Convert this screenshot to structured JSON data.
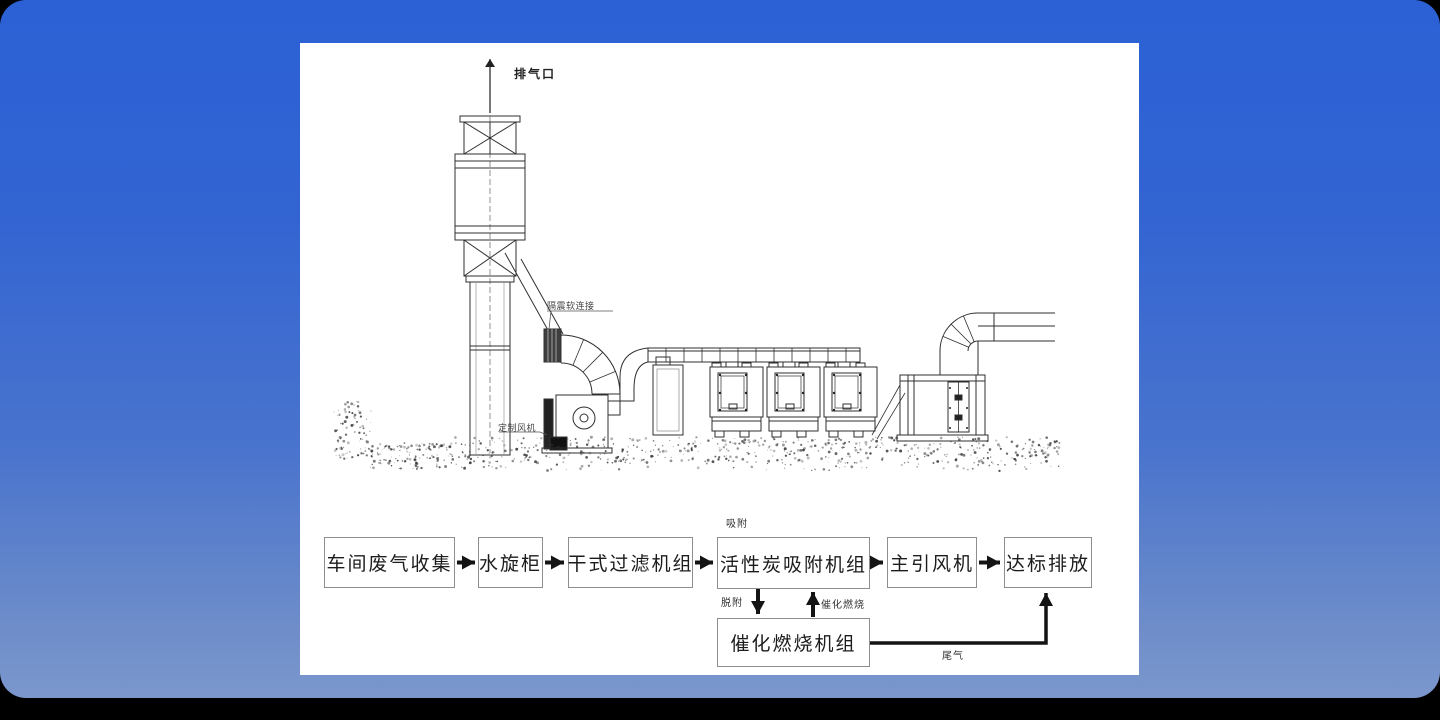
{
  "colors": {
    "page_background": "#000000",
    "slide_background_top": "#2b61d5",
    "slide_background_bottom": "#7b97cd",
    "panel_background": "#ffffff",
    "line_color": "#2f2f2f",
    "flow_box_border": "#8e8e8e",
    "flow_arrow": "#141414"
  },
  "equipment_diagram": {
    "labels": {
      "exhaust_outlet": "排气口",
      "vibration_flex_connector": "隔震软连接",
      "custom_fan": "定制风机"
    }
  },
  "flowchart": {
    "boxes": [
      {
        "label": "车间废气收集"
      },
      {
        "label": "水旋柜"
      },
      {
        "label": "干式过滤机组"
      },
      {
        "label": "活性炭吸附机组"
      },
      {
        "label": "主引风机"
      },
      {
        "label": "达标排放"
      },
      {
        "label": "催化燃烧机组"
      }
    ],
    "flow_labels": {
      "adsorption": "吸附",
      "desorption": "脱附",
      "catalytic_combustion": "催化燃烧",
      "tail_gas": "尾气"
    }
  }
}
